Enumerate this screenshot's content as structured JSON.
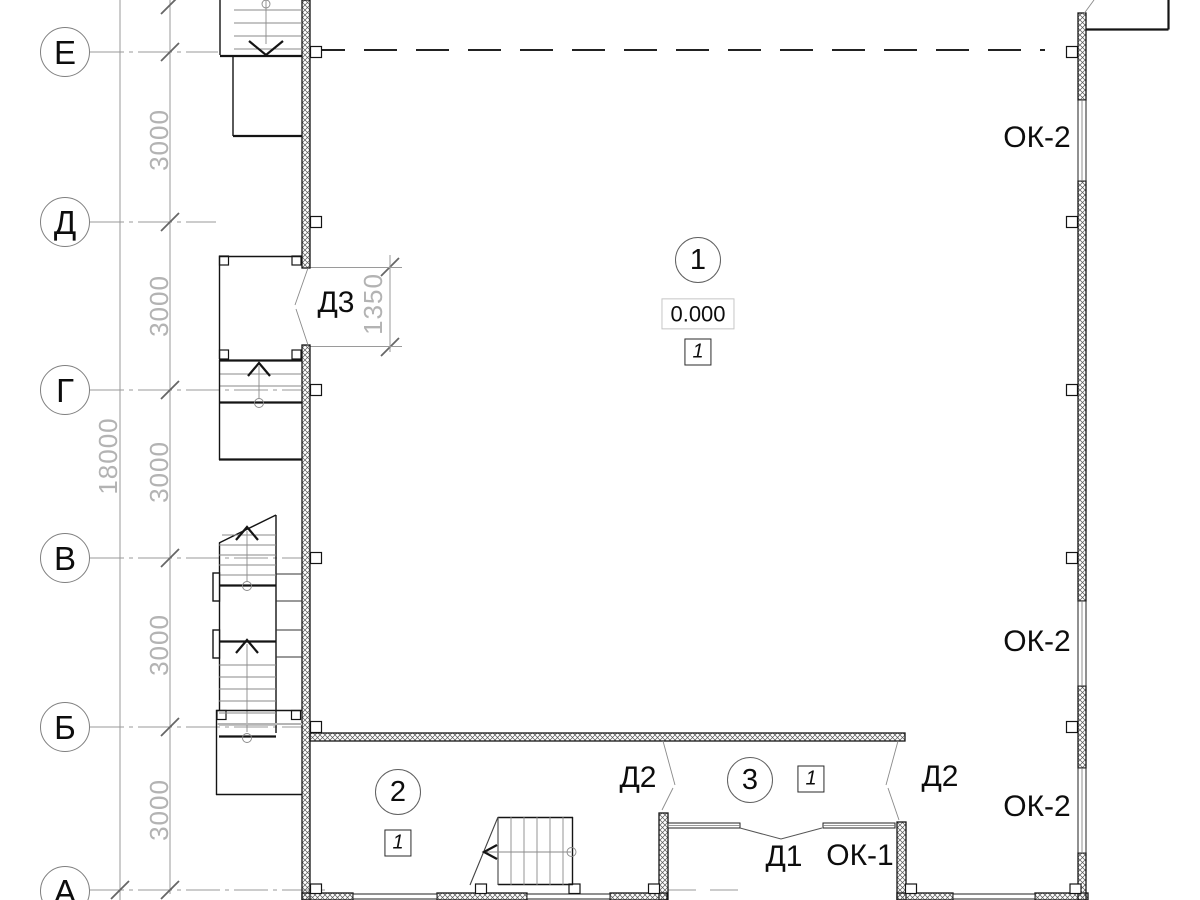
{
  "colors": {
    "background": "#ffffff",
    "line": "#141414",
    "thin_line": "#8a8a8a",
    "dim_text": "#b3b3b3",
    "axis_circle_border": "#808080"
  },
  "axes": {
    "labels": [
      "Е",
      "Д",
      "Г",
      "В",
      "Б",
      "А"
    ]
  },
  "dimensions": {
    "total": "18000",
    "bays": [
      "3000",
      "3000",
      "3000",
      "3000",
      "3000"
    ],
    "door_opening": "1350"
  },
  "rooms": [
    {
      "number": "1",
      "elevation": "0.000",
      "floor_tag": "1"
    },
    {
      "number": "2",
      "floor_tag": "1"
    },
    {
      "number": "3",
      "floor_tag": "1"
    }
  ],
  "openings": {
    "door_d1": "Д1",
    "door_d2_left": "Д2",
    "door_d2_right": "Д2",
    "door_d3": "Д3",
    "window_ok1": "ОК-1",
    "window_ok2_top": "ОК-2",
    "window_ok2_middle": "ОК-2",
    "window_ok2_bottom": "ОК-2"
  }
}
